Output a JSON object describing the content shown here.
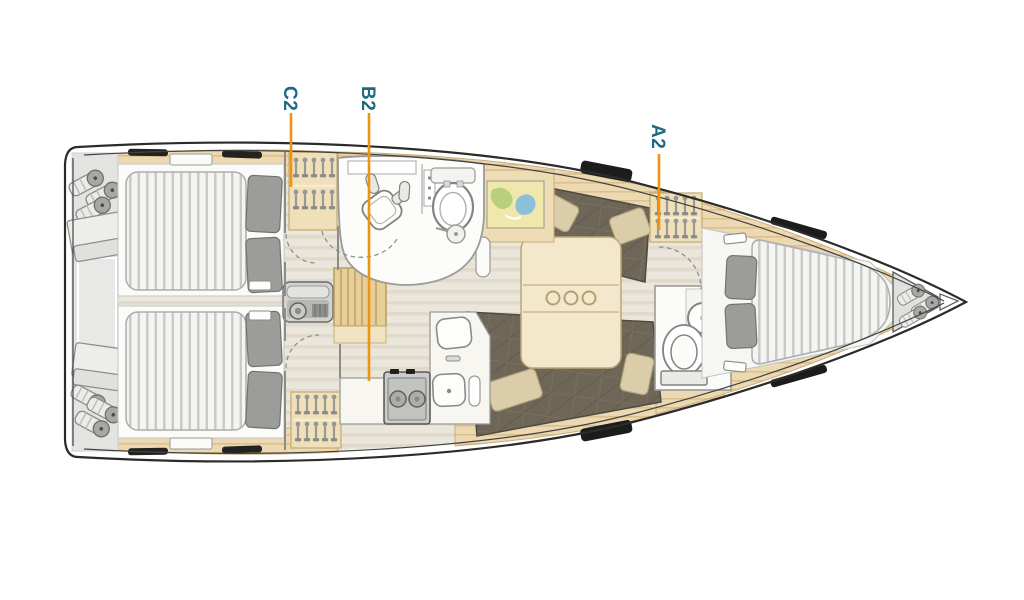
{
  "callouts": [
    {
      "label": "C2"
    },
    {
      "label": "B2"
    },
    {
      "label": "A2"
    }
  ],
  "colors": {
    "label_text": "#1e6a82",
    "leader_line": "#ef940e",
    "hull_line": "#2b2b29",
    "wood": "#ecd9b2",
    "background": "#ffffff"
  }
}
